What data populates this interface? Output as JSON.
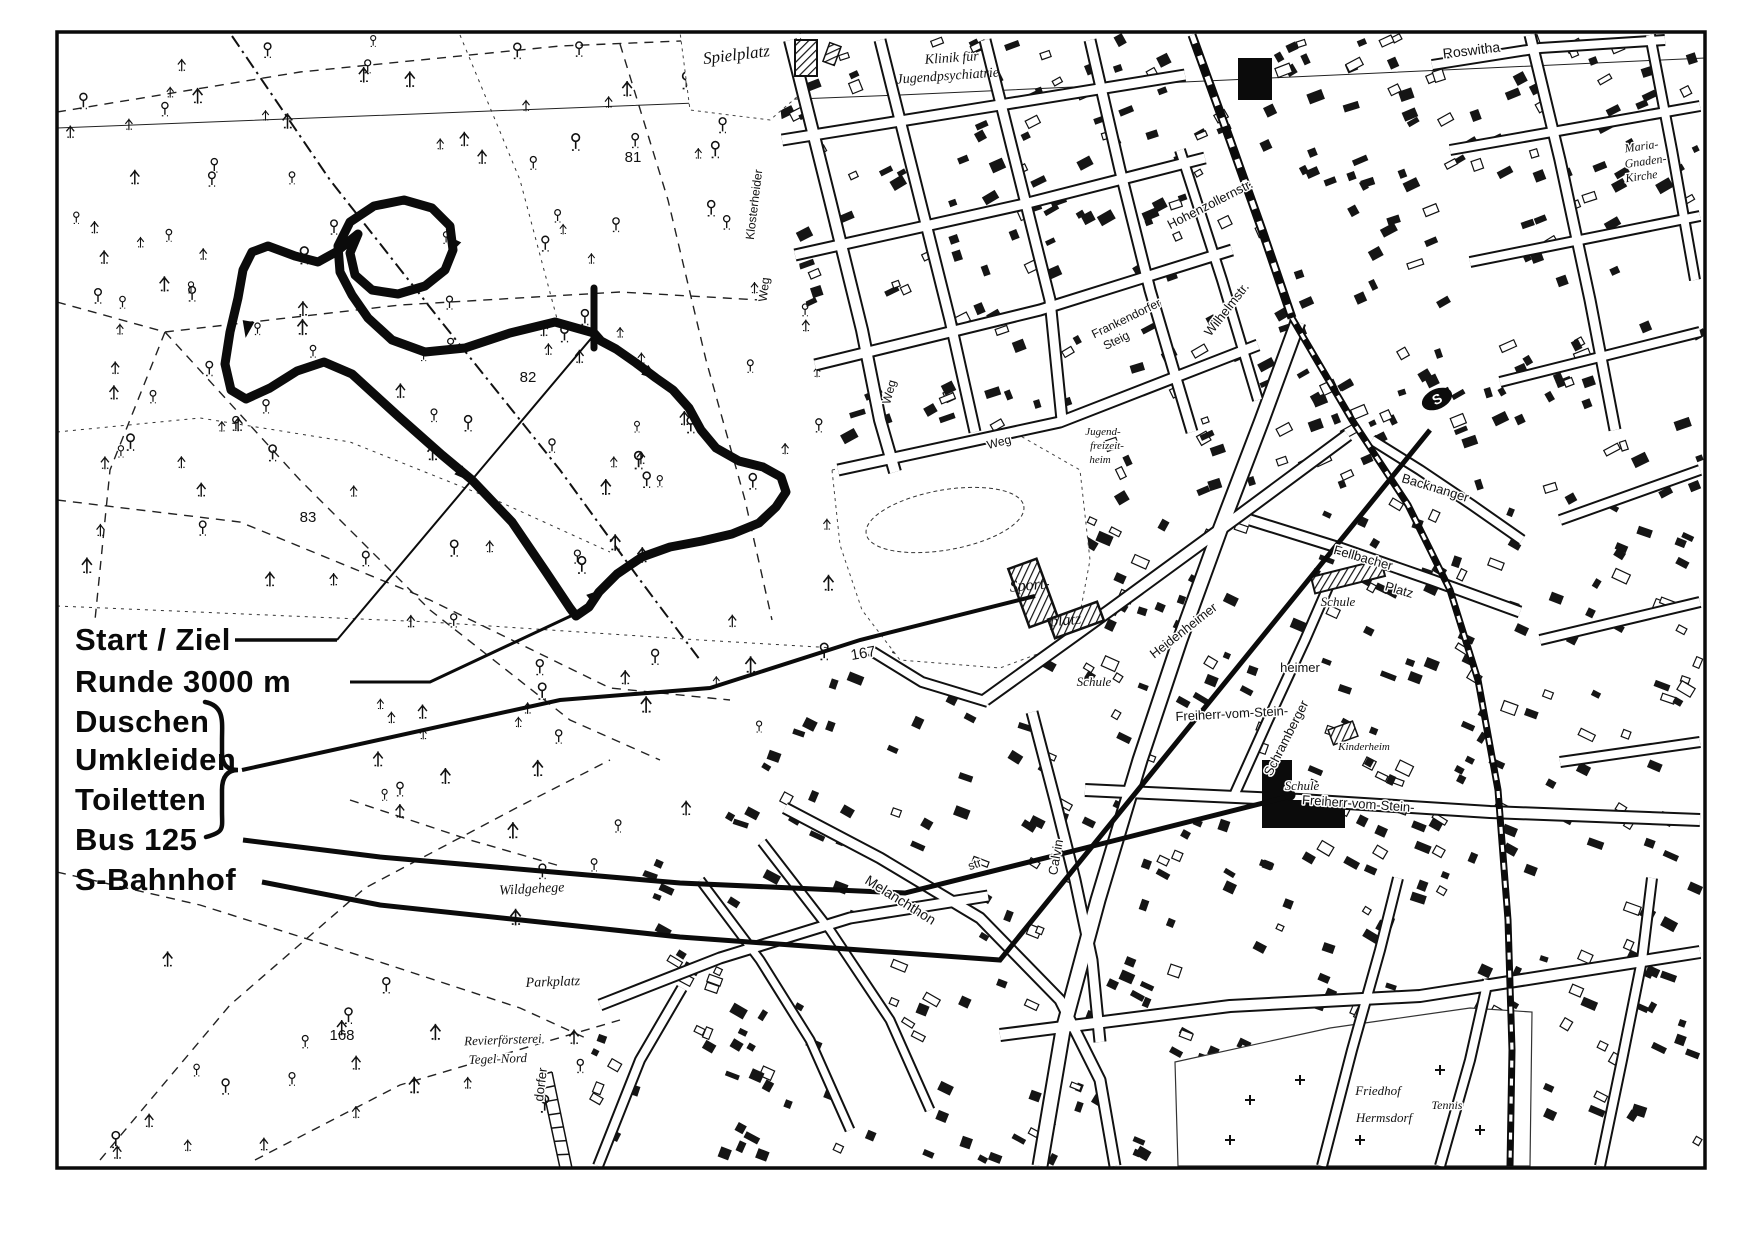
{
  "map": {
    "colors": {
      "ink": "#111111",
      "paper": "#ffffff"
    },
    "legend": {
      "items": [
        {
          "id": "start-ziel",
          "label": "Start / Ziel"
        },
        {
          "id": "runde",
          "label": "Runde 3000 m"
        },
        {
          "id": "duschen",
          "label": "Duschen"
        },
        {
          "id": "umkleiden",
          "label": "Umkleiden"
        },
        {
          "id": "toiletten",
          "label": "Toiletten"
        },
        {
          "id": "bus",
          "label": "Bus 125"
        },
        {
          "id": "s-bahnhof",
          "label": "S-Bahnhof"
        }
      ]
    },
    "station_s": "S",
    "labels": [
      {
        "t": "Spielplatz",
        "x": 737,
        "y": 60,
        "r": -7,
        "s": 17,
        "f": "it",
        "h": 0
      },
      {
        "t": "Klinik für",
        "x": 952,
        "y": 62,
        "r": -4,
        "s": 14,
        "f": "it",
        "h": 0
      },
      {
        "t": "Jugendpsychiatrie",
        "x": 948,
        "y": 80,
        "r": -4,
        "s": 14,
        "f": "it",
        "h": 0
      },
      {
        "t": "81",
        "x": 633,
        "y": 162,
        "r": 0,
        "s": 15,
        "f": "sa",
        "h": 0
      },
      {
        "t": "82",
        "x": 528,
        "y": 382,
        "r": 0,
        "s": 15,
        "f": "sa",
        "h": 0
      },
      {
        "t": "83",
        "x": 308,
        "y": 522,
        "r": 0,
        "s": 15,
        "f": "sa",
        "h": 0
      },
      {
        "t": "167",
        "x": 864,
        "y": 658,
        "r": -10,
        "s": 15,
        "f": "sa",
        "h": 1
      },
      {
        "t": "168",
        "x": 342,
        "y": 1040,
        "r": 0,
        "s": 15,
        "f": "sa",
        "h": 0
      },
      {
        "t": "Roswitha",
        "x": 1472,
        "y": 55,
        "r": -7,
        "s": 14,
        "f": "sa",
        "h": 1
      },
      {
        "t": "Maria-",
        "x": 1642,
        "y": 150,
        "r": -8,
        "s": 12,
        "f": "it",
        "h": 1
      },
      {
        "t": "Gnaden-",
        "x": 1646,
        "y": 165,
        "r": -8,
        "s": 12,
        "f": "it",
        "h": 1
      },
      {
        "t": "Kirche",
        "x": 1642,
        "y": 180,
        "r": -8,
        "s": 12,
        "f": "it",
        "h": 1
      },
      {
        "t": "Hohenzollernstr.",
        "x": 1212,
        "y": 208,
        "r": -27,
        "s": 13,
        "f": "sa",
        "h": 1
      },
      {
        "t": "Wilhelmstr.",
        "x": 1230,
        "y": 312,
        "r": -52,
        "s": 13,
        "f": "sa",
        "h": 1
      },
      {
        "t": "Frankendorfer",
        "x": 1128,
        "y": 322,
        "r": -26,
        "s": 12,
        "f": "sa",
        "h": 1
      },
      {
        "t": "Steig",
        "x": 1118,
        "y": 344,
        "r": -26,
        "s": 12,
        "f": "sa",
        "h": 1
      },
      {
        "t": "Weg",
        "x": 1000,
        "y": 446,
        "r": -15,
        "s": 12,
        "f": "sa",
        "h": 1
      },
      {
        "t": "Weg",
        "x": 893,
        "y": 393,
        "r": -75,
        "s": 12,
        "f": "sa",
        "h": 1
      },
      {
        "t": "Klosterheider",
        "x": 758,
        "y": 205,
        "r": -83,
        "s": 12,
        "f": "sa",
        "h": 1
      },
      {
        "t": "Weg",
        "x": 768,
        "y": 290,
        "r": -83,
        "s": 12,
        "f": "sa",
        "h": 1
      },
      {
        "t": "Jugend-",
        "x": 1103,
        "y": 435,
        "r": 0,
        "s": 11,
        "f": "it",
        "h": 1
      },
      {
        "t": "freizeit-",
        "x": 1107,
        "y": 449,
        "r": 0,
        "s": 11,
        "f": "it",
        "h": 1
      },
      {
        "t": "heim",
        "x": 1100,
        "y": 463,
        "r": 0,
        "s": 11,
        "f": "it",
        "h": 1
      },
      {
        "t": "Sport-",
        "x": 1030,
        "y": 590,
        "r": -5,
        "s": 16,
        "f": "it",
        "h": 0
      },
      {
        "t": "platz",
        "x": 1066,
        "y": 625,
        "r": -5,
        "s": 16,
        "f": "it",
        "h": 0
      },
      {
        "t": "Schule",
        "x": 1094,
        "y": 686,
        "r": 0,
        "s": 13,
        "f": "it",
        "h": 1
      },
      {
        "t": "Schule",
        "x": 1338,
        "y": 606,
        "r": 0,
        "s": 13,
        "f": "it",
        "h": 1
      },
      {
        "t": "Schule",
        "x": 1302,
        "y": 790,
        "r": 0,
        "s": 13,
        "f": "it",
        "h": 1
      },
      {
        "t": "Fellbacher",
        "x": 1362,
        "y": 562,
        "r": 16,
        "s": 13,
        "f": "sa",
        "h": 1
      },
      {
        "t": "Platz",
        "x": 1398,
        "y": 594,
        "r": 16,
        "s": 13,
        "f": "sa",
        "h": 1
      },
      {
        "t": "Backnanger",
        "x": 1434,
        "y": 492,
        "r": 17,
        "s": 13,
        "f": "sa",
        "h": 1
      },
      {
        "t": "Heidenheimer",
        "x": 1186,
        "y": 634,
        "r": -38,
        "s": 13,
        "f": "sa",
        "h": 1
      },
      {
        "t": "heimer",
        "x": 1300,
        "y": 672,
        "r": 0,
        "s": 13,
        "f": "sa",
        "h": 1
      },
      {
        "t": "Schramberger",
        "x": 1290,
        "y": 740,
        "r": -63,
        "s": 13,
        "f": "sa",
        "h": 1
      },
      {
        "t": "Kinderheim",
        "x": 1364,
        "y": 750,
        "r": 0,
        "s": 11,
        "f": "it",
        "h": 1
      },
      {
        "t": "Freiherr-vom-Stein-",
        "x": 1232,
        "y": 718,
        "r": -3,
        "s": 13,
        "f": "sa",
        "h": 1
      },
      {
        "t": "Freiherr-vom-Stein-",
        "x": 1358,
        "y": 808,
        "r": 4,
        "s": 13,
        "f": "sa",
        "h": 1
      },
      {
        "t": "Melanchthon",
        "x": 898,
        "y": 904,
        "r": 32,
        "s": 14,
        "f": "sa",
        "h": 1
      },
      {
        "t": "str",
        "x": 976,
        "y": 868,
        "r": -20,
        "s": 12,
        "f": "sa",
        "h": 1
      },
      {
        "t": "Calvin",
        "x": 1060,
        "y": 858,
        "r": -80,
        "s": 13,
        "f": "sa",
        "h": 1
      },
      {
        "t": "dorfer",
        "x": 545,
        "y": 1085,
        "r": -83,
        "s": 13,
        "f": "sa",
        "h": 1
      },
      {
        "t": "Wildgehege",
        "x": 532,
        "y": 893,
        "r": -3,
        "s": 14,
        "f": "it",
        "h": 1
      },
      {
        "t": "Parkplatz",
        "x": 553,
        "y": 986,
        "r": -2,
        "s": 14,
        "f": "it",
        "h": 1
      },
      {
        "t": "Revierförsterei",
        "x": 503,
        "y": 1044,
        "r": -2,
        "s": 13,
        "f": "it",
        "h": 1
      },
      {
        "t": "Tegel-Nord",
        "x": 498,
        "y": 1063,
        "r": -2,
        "s": 13,
        "f": "it",
        "h": 1
      },
      {
        "t": "Friedhof",
        "x": 1378,
        "y": 1095,
        "r": 0,
        "s": 13,
        "f": "it",
        "h": 1
      },
      {
        "t": "Hermsdorf",
        "x": 1384,
        "y": 1122,
        "r": 0,
        "s": 13,
        "f": "it",
        "h": 1
      },
      {
        "t": "Tennis",
        "x": 1447,
        "y": 1109,
        "r": 0,
        "s": 12,
        "f": "it",
        "h": 1
      }
    ]
  }
}
